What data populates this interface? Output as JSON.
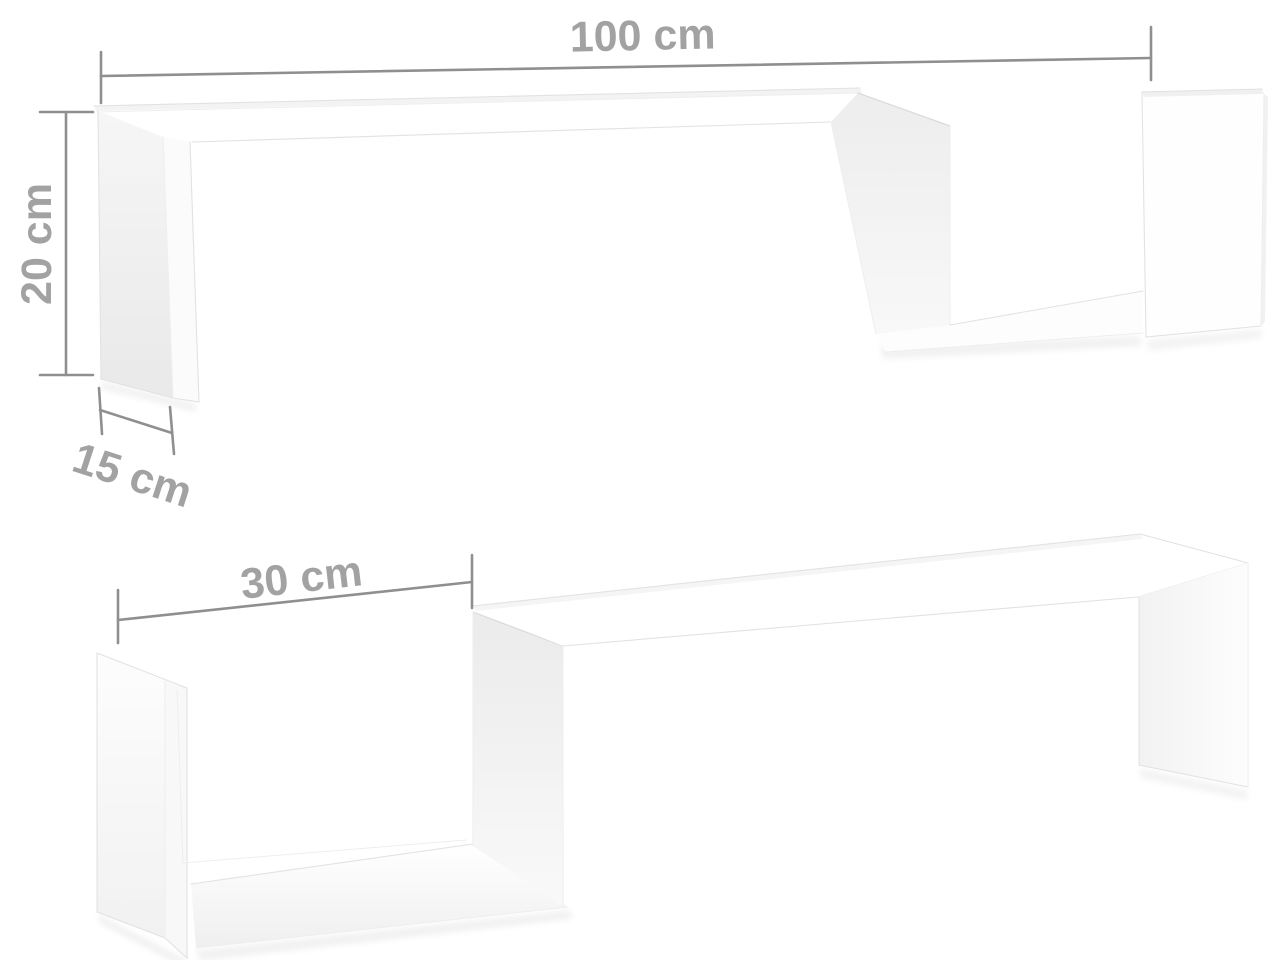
{
  "image": {
    "description": "Product dimension diagram of two white S-shaped wall shelves on a white background",
    "background_color": "#ffffff"
  },
  "style": {
    "dimension_line_color": "#8f8f8f",
    "dimension_label_color": "#a2a2a2",
    "shelf_fill_color": "#ffffff",
    "shelf_shading_color": "#ededed",
    "shelf_edge_color": "#e2e2e2"
  },
  "dimensions": {
    "length": {
      "label": "100 cm"
    },
    "height": {
      "label": "20 cm"
    },
    "depth": {
      "label": "15 cm"
    },
    "opening": {
      "label": "30 cm"
    }
  }
}
